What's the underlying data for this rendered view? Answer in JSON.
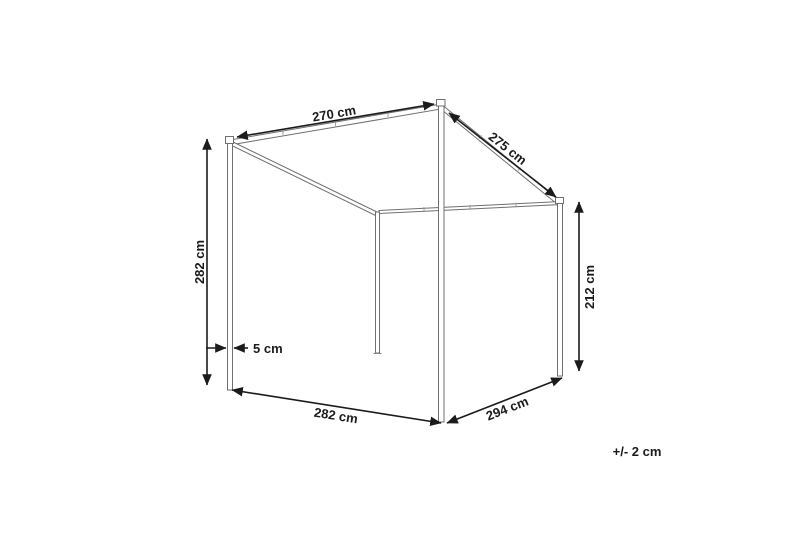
{
  "diagram": {
    "kind": "canopy-frame-dimension-drawing",
    "labels": {
      "roof_front": "270 cm",
      "roof_side": "275 cm",
      "height_front": "282 cm",
      "height_back": "212 cm",
      "post_width": "5 cm",
      "base_front": "282 cm",
      "base_side": "294 cm",
      "tolerance": "+/- 2 cm"
    },
    "colors": {
      "background": "#ffffff",
      "frame_stroke": "#6f6f6f",
      "dimension_stroke": "#1b1b1b",
      "label_text": "#1b1b1b"
    }
  }
}
